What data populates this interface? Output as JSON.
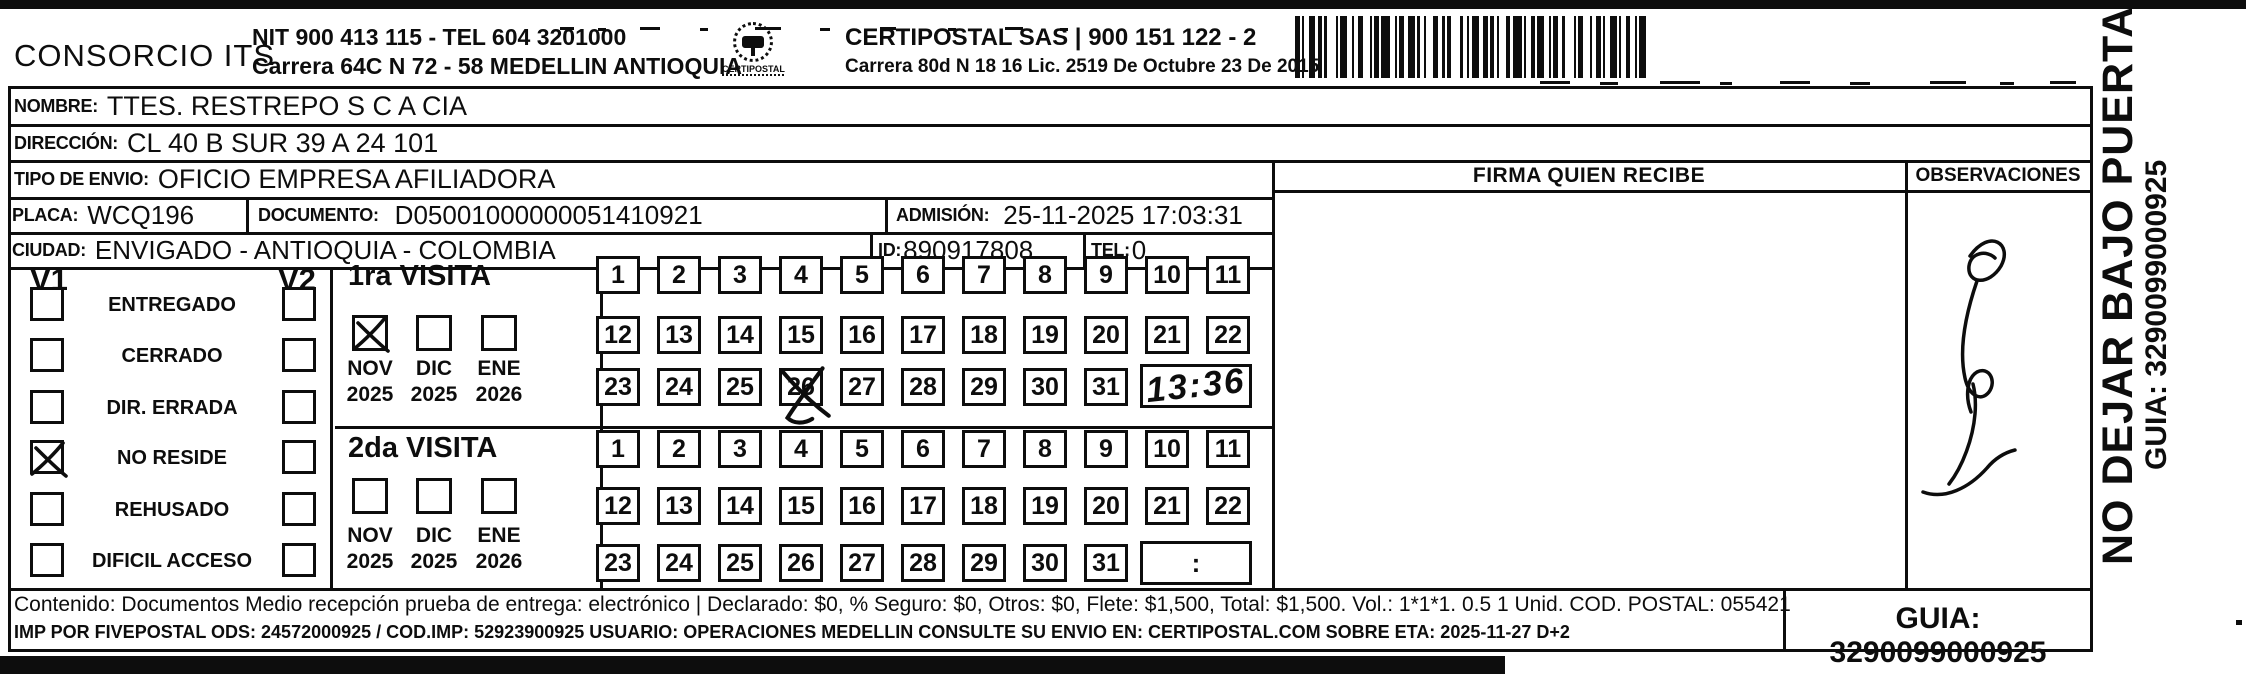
{
  "header": {
    "company": "CONSORCIO ITS",
    "nit_tel": "NIT 900 413 115 - TEL 604 3201000",
    "company_address": "Carrera 64C N 72 - 58 MEDELLIN ANTIOQUIA",
    "logo_text": "CERTIPOSTAL",
    "operator": "CERTIPOSTAL SAS | 900 151 122 - 2",
    "operator_address": "Carrera 80d N 18 16  Lic. 2519 De Octubre 23 De 2015"
  },
  "shipment": {
    "nombre_label": "NOMBRE:",
    "nombre": "TTES. RESTREPO S C A CIA",
    "direccion_label": "DIRECCIÓN:",
    "direccion": "CL 40 B SUR 39 A 24 101",
    "tipo_envio_label": "TIPO DE ENVIO:",
    "tipo_envio": "OFICIO EMPRESA AFILIADORA",
    "placa_label": "PLACA:",
    "placa": "WCQ196",
    "documento_label": "DOCUMENTO:",
    "documento": "D05001000000051410921",
    "admision_label": "ADMISIÓN:",
    "admision": "25-11-2025 17:03:31",
    "ciudad_label": "CIUDAD:",
    "ciudad": "ENVIGADO - ANTIOQUIA - COLOMBIA",
    "id_label": "ID:",
    "id_value": "890917808",
    "tel_label": "TEL:",
    "tel": "0"
  },
  "status_panel": {
    "v1_header": "V1",
    "v2_header": "V2",
    "rows": [
      {
        "label": "ENTREGADO",
        "v1": false,
        "v2": false
      },
      {
        "label": "CERRADO",
        "v1": false,
        "v2": false
      },
      {
        "label": "DIR. ERRADA",
        "v1": false,
        "v2": false
      },
      {
        "label": "NO RESIDE",
        "v1": true,
        "v2": false
      },
      {
        "label": "REHUSADO",
        "v1": false,
        "v2": false
      },
      {
        "label": "DIFICIL ACCESO",
        "v1": false,
        "v2": false
      }
    ]
  },
  "visits": [
    {
      "title": "1ra VISITA",
      "months": [
        {
          "month": "NOV",
          "year": "2025",
          "checked": true
        },
        {
          "month": "DIC",
          "year": "2025",
          "checked": false
        },
        {
          "month": "ENE",
          "year": "2026",
          "checked": false
        }
      ],
      "days_start": 1,
      "days_end": 31,
      "crossed_days": [
        26
      ],
      "time_written": "13:36",
      "time_placeholder": ""
    },
    {
      "title": "2da VISITA",
      "months": [
        {
          "month": "NOV",
          "year": "2025",
          "checked": false
        },
        {
          "month": "DIC",
          "year": "2025",
          "checked": false
        },
        {
          "month": "ENE",
          "year": "2026",
          "checked": false
        }
      ],
      "days_start": 1,
      "days_end": 31,
      "crossed_days": [],
      "time_written": "",
      "time_placeholder": ":"
    }
  ],
  "delivery_panel": {
    "firma_header": "FIRMA QUIEN RECIBE",
    "observaciones_header": "OBSERVACIONES",
    "signature_present": true
  },
  "side_banner": {
    "instruction": "NO DEJAR BAJO PUERTA",
    "guia": "GUIA: 3290099000925"
  },
  "footer": {
    "content_line": "Contenido: Documentos Medio recepción prueba de entrega: electrónico | Declarado: $0, % Seguro: $0, Otros: $0, Flete: $1,500, Total: $1,500. Vol.: 1*1*1. 0.5 1 Unid. COD. POSTAL: 055421",
    "print_line": "IMP POR FIVEPOSTAL ODS: 24572000925 / COD.IMP: 52923900925 USUARIO: OPERACIONES MEDELLIN CONSULTE SU ENVIO EN: CERTIPOSTAL.COM SOBRE ETA: 2025-11-27 D+2",
    "guia_label": "GUIA: 3290099000925"
  },
  "colors": {
    "ink": "#0d0d0d",
    "paper": "#ffffff"
  }
}
